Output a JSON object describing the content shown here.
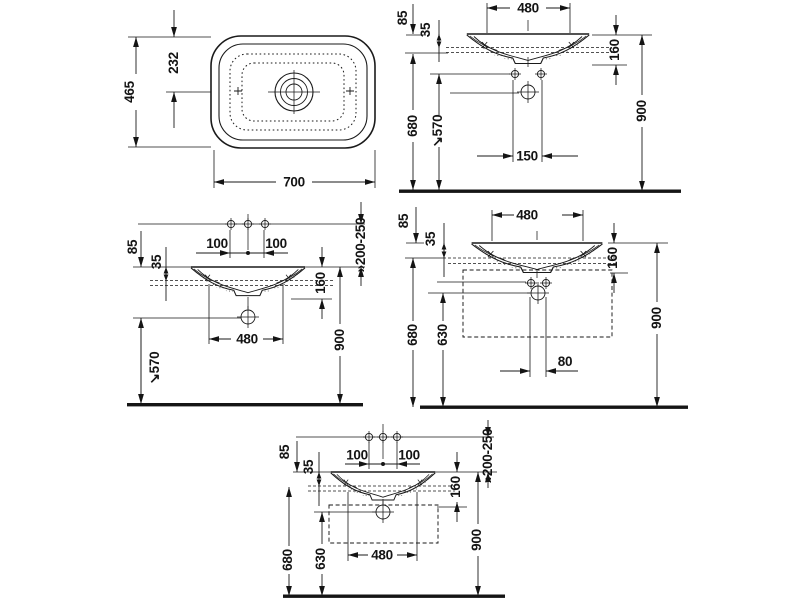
{
  "colors": {
    "line": "#1a1a1a",
    "background": "#ffffff"
  },
  "views": {
    "plan": {
      "width": "700",
      "depth": "465",
      "center_offset": "232"
    },
    "front_wall": {
      "fixing_width": "480",
      "top_to_rim": "85",
      "rim_to_mount": "35",
      "rim_to_outlet": "160",
      "mount_height": "680",
      "trap_height": "↘570",
      "fixing_spacing": "150",
      "rim_height": "900"
    },
    "front_deck_taps": {
      "tap_left": "100",
      "tap_right": "100",
      "top_to_rim": "85",
      "rim_to_mount": "35",
      "rim_to_outlet": "160",
      "trap_height": "↘570",
      "basin_width": "480",
      "rim_height": "900",
      "tap_range": "»200-250"
    },
    "front_furniture": {
      "fixing_width": "480",
      "top_to_rim": "85",
      "rim_to_mount": "35",
      "rim_to_outlet": "160",
      "mount_height": "680",
      "furniture_height": "630",
      "outlet_offset": "80",
      "rim_height": "900"
    },
    "front_furniture_taps": {
      "tap_left": "100",
      "tap_right": "100",
      "top_to_rim": "85",
      "rim_to_mount": "35",
      "rim_to_outlet": "160",
      "mount_height": "680",
      "furniture_height": "630",
      "basin_width": "480",
      "rim_height": "900",
      "tap_range": "»200-250"
    }
  }
}
